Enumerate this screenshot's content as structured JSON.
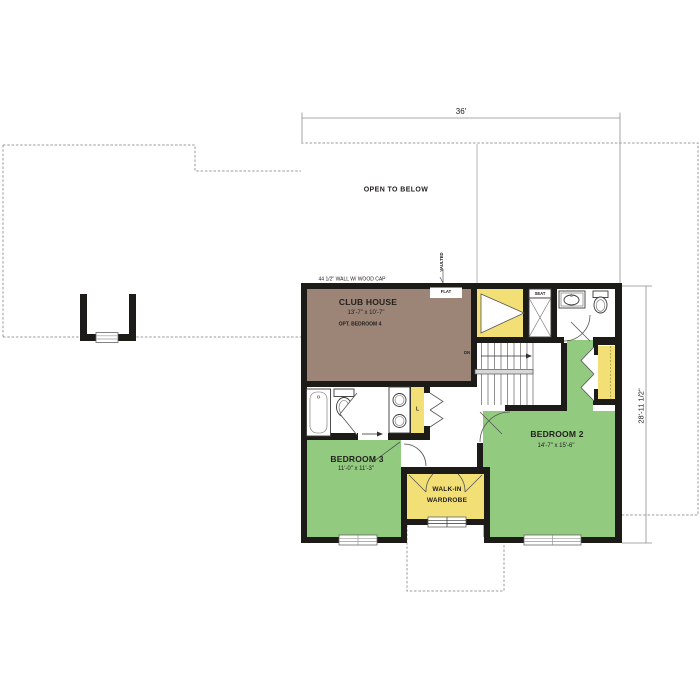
{
  "dimensions": {
    "width": "36'",
    "height": "28'-11 1/2\""
  },
  "annotations": {
    "open_to_below": "OPEN TO BELOW",
    "wall_note": "44 1/2\" WALL W/ WOOD CAP",
    "vaulted": "VAULTED",
    "flat": "FLAT",
    "down": "DN",
    "seat": "SEAT",
    "linen": "L"
  },
  "rooms": {
    "club_house": {
      "name": "CLUB HOUSE",
      "size": "13'-7\" x 10'-7\"",
      "note": "OPT. BEDROOM 4"
    },
    "bedroom_2": {
      "name": "BEDROOM 2",
      "size": "14'-7\" x 15'-6\""
    },
    "bedroom_3": {
      "name": "BEDROOM 3",
      "size": "11'-0\" x 11'-3\""
    },
    "wardrobe": {
      "line1": "WALK-IN",
      "line2": "WARDROBE"
    }
  },
  "colors": {
    "bedroom_green": "#92ca7f",
    "closet_yellow": "#f2df76",
    "club_brown": "#9c8477",
    "wall": "#1d1b18",
    "outline": "#9b9b9b"
  }
}
